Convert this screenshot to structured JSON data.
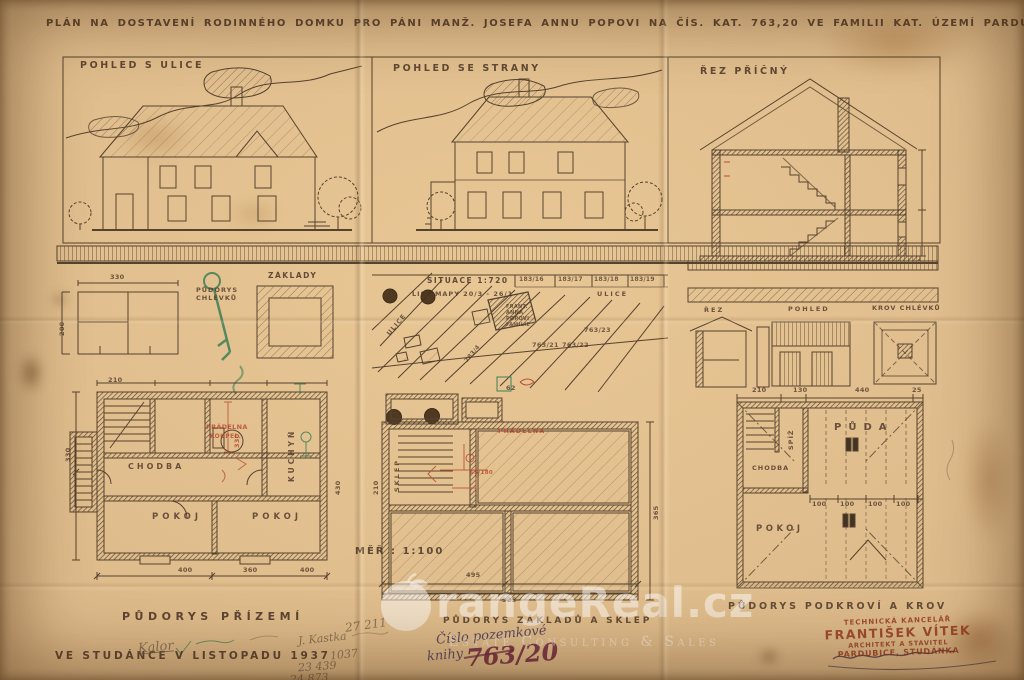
{
  "title": "PLÁN NA DOSTAVENÍ RODINNÉHO DOMKU PRO PÁNI MANŽ. JOSEFA ANNU POPOVI NA ČÍS. KAT. 763,20 VE FAMILII KAT. ÚZEMÍ PARDUBICE.",
  "top": {
    "street_view": "POHLED S ULICE",
    "side_view": "POHLED SE STRANY",
    "cross_section": "ŘEZ PŘÍČNÝ"
  },
  "middle": {
    "chlevky_plan": "PŮDORYS CHLÉVKŮ",
    "chlevky_dims": [
      "330",
      "200"
    ],
    "foundations": "ZÁKLADY",
    "site_plan": "SITUACE 1:720",
    "map_sheet": "LIST MAPY 20/3 - 26/1",
    "street1": "ULICE",
    "street2": "ULICE",
    "parcels_top": [
      "183/16",
      "183/17",
      "183/18",
      "183/19"
    ],
    "parcel_763_21": "763/21",
    "parcel_763_22": "763/22",
    "parcel_763_23": "763/23",
    "parcel_783_4": "783/4",
    "owner": [
      "FRANT.",
      "ANNA",
      "POPOVI",
      "FAMILIE"
    ],
    "section_small": "ŘEZ",
    "view_small": "POHLED",
    "roof_small": "KROV CHLÉVKŮ"
  },
  "plans": {
    "scale": "MĚŘ : 1:100",
    "ground": {
      "label": "PŮDORYS PŘÍZEMÍ",
      "rooms": {
        "hall": "CHODBA",
        "room1": "POKOJ",
        "room2": "POKOJ",
        "kitchen": "KUCHYŇ",
        "laundry": "PRÁDELNA",
        "bath": "KOUPEL."
      },
      "dims": [
        "400",
        "360",
        "400",
        "330",
        "430",
        "210"
      ],
      "red_dim": "330"
    },
    "basement": {
      "label": "PŮDORYS ZÁKLADŮ A SKLEP",
      "rooms": {
        "cellar": "SKLEP",
        "laundry": "PRÁDELNA"
      },
      "dims": [
        "495",
        "925",
        "62",
        "365",
        "210"
      ],
      "red_note": "65/180"
    },
    "attic": {
      "label": "PŮDORYS PODKROVÍ A KROV",
      "rooms": {
        "attic": "PŮDA",
        "hall": "CHODBA",
        "room": "POKOJ",
        "pantry": "SPÍŽ"
      },
      "dims": [
        "210",
        "130",
        "440",
        "25",
        "100",
        "100",
        "100",
        "100"
      ]
    }
  },
  "footer": {
    "place_date": "VE STUDÁNCE V LISTOPADU 1937",
    "stamp": {
      "line1": "TECHNICKÁ KANCELÁŘ",
      "line2": "FRANTIŠEK VÍTEK",
      "line3": "ARCHITEKT A STAVITEL",
      "line4": "PARDUBICE, STUDÁNKA"
    },
    "notes": {
      "kalor": "Kalor",
      "name": "J. Kastka",
      "n1": "27 211",
      "n2": "1037",
      "n3": "23 439",
      "n4": "24 873",
      "ink1": "Číslo pozemkové",
      "ink2": "knihy",
      "parcel": "763/20"
    }
  },
  "watermark": {
    "text": "rangeReal.cz",
    "tagline": "Estate Consulting & Sales"
  },
  "colors": {
    "paper": "#ddba8a",
    "ink": "#4a3827",
    "red_ink": "#b0402a",
    "green_ink": "#2f7a52",
    "stamp_red": "#96381f"
  }
}
